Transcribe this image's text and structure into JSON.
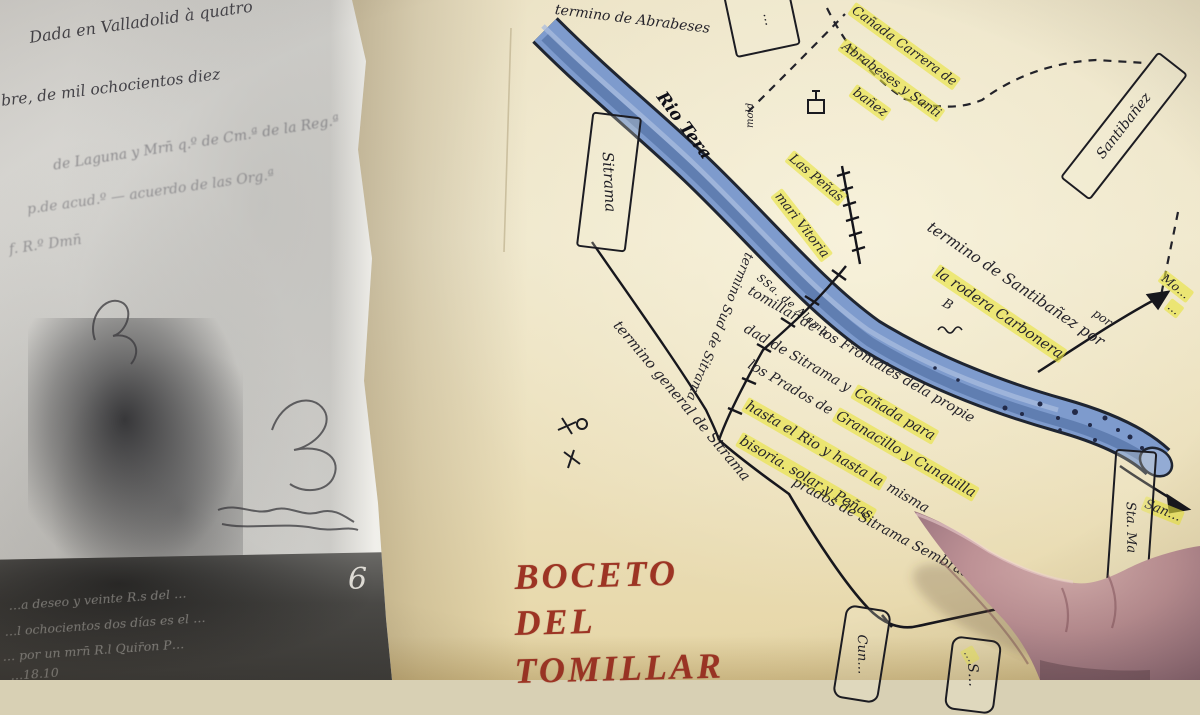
{
  "left_page": {
    "heading_lines": [
      "Dada en Valladolid à quatro",
      "bre, de mil ochocientos diez"
    ],
    "faded_lines": [
      "de Laguna y Mrn̄ q.º de Cm.ª de la Reg.ª",
      "p.de acud.º — acuerdo de las Org.ª",
      "f. R.º Dmn̄"
    ],
    "page_number": "6",
    "dark_band_lines": [
      "…a deseo y veinte R.s del …",
      "…l ochocientos dos días es el …",
      "… por un mrn̄ R.l Quir̄on P…",
      "…18.10"
    ]
  },
  "map_page": {
    "title_lines": [
      "BOCETO",
      "DEL",
      "TOMILLAR"
    ],
    "river": {
      "name": "Rio Tera",
      "note": "SSa. de Alama"
    },
    "territory_labels": {
      "top": "termino de Abrabeses",
      "canada_l1": "Cañada Carrera de",
      "canada_l2": "Abrabeses y Santi",
      "canada_l3": "bañez",
      "santibanez_l1": "termino de Santibañez por",
      "santibanez_l2": "la rodera Carbonera",
      "sud": "termino Sud de Sitrama",
      "general": "termino general de Sitrama"
    },
    "features": {
      "las_penas": "Las Peñas",
      "mari_vitoria": "mari Vitoria",
      "mill": "mold",
      "b_mark": "B",
      "por_fragment": "por",
      "hidden_fragment": "…"
    },
    "description_lines": [
      {
        "pre": "tomillar de los Frontales dela propie",
        "hl": "",
        "post": ""
      },
      {
        "pre": "dad de Sitrama y ",
        "hl": "Cañada para",
        "post": ""
      },
      {
        "pre": "los Prados de ",
        "hl": "Granacillo y Cunquilla",
        "post": ""
      },
      {
        "pre": "",
        "hl": "hasta el Rio y hasta la",
        "post": " misma"
      },
      {
        "pre": "",
        "hl": "bisoria. solar y Peñas",
        "post": ""
      },
      {
        "pre": "prados de Sitrama Sembrados",
        "hl": "",
        "post": ""
      }
    ],
    "boxes": {
      "sitrama": "Sitrama",
      "santibanez": "Santibañez",
      "top_box": "…",
      "sta_ma": "Sta. Ma",
      "cun": "Cun…",
      "s": "S…"
    },
    "edge_labels": {
      "right_top_1": "Mo…",
      "right_top_2": "…",
      "right_bottom": "San…"
    }
  },
  "colors": {
    "paper": "#efe7cb",
    "river_blue": "#7e9bcd",
    "highlight_yellow": "#e8e43e",
    "title_red": "#9d3424",
    "ink": "#23222a",
    "skin": "#c4989b"
  }
}
